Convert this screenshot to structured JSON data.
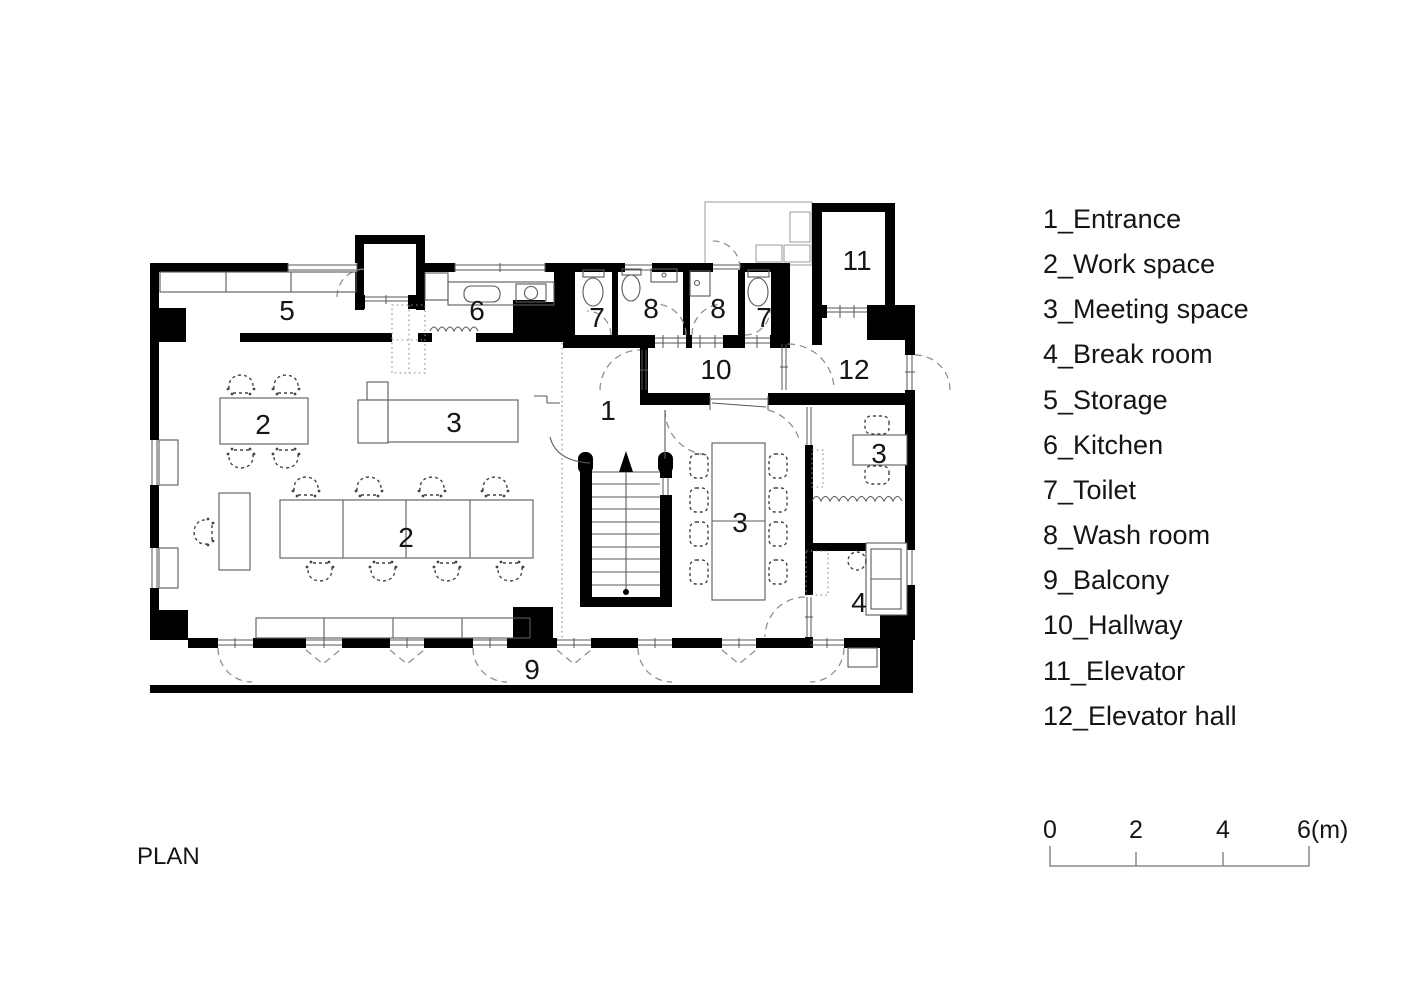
{
  "title": {
    "label": "PLAN"
  },
  "legend": {
    "items": [
      {
        "label": "1_Entrance"
      },
      {
        "label": "2_Work space"
      },
      {
        "label": "3_Meeting space"
      },
      {
        "label": "4_Break room"
      },
      {
        "label": "5_Storage"
      },
      {
        "label": "6_Kitchen"
      },
      {
        "label": "7_Toilet"
      },
      {
        "label": "8_Wash room"
      },
      {
        "label": "9_Balcony"
      },
      {
        "label": "10_Hallway"
      },
      {
        "label": "11_Elevator"
      },
      {
        "label": "12_Elevator hall"
      }
    ]
  },
  "scale_bar": {
    "ticks": [
      "0",
      "2",
      "4",
      "6(m)"
    ]
  },
  "plan": {
    "room_labels": [
      {
        "number": "5"
      },
      {
        "number": "6"
      },
      {
        "number": "7"
      },
      {
        "number": "8"
      },
      {
        "number": "8"
      },
      {
        "number": "7"
      },
      {
        "number": "11"
      },
      {
        "number": "10"
      },
      {
        "number": "12"
      },
      {
        "number": "1"
      },
      {
        "number": "2"
      },
      {
        "number": "3"
      },
      {
        "number": "2"
      },
      {
        "number": "3"
      },
      {
        "number": "3"
      },
      {
        "number": "4"
      },
      {
        "number": "9"
      }
    ],
    "colors": {
      "wall": "#000000",
      "furniture_line": "#5a5a5a",
      "text": "#151515"
    }
  }
}
